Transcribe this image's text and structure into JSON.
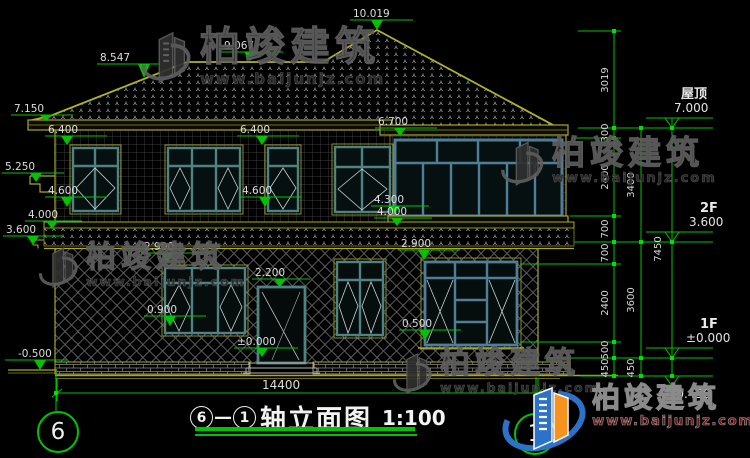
{
  "colors": {
    "green": "#00c400",
    "olive": "#a8a82c",
    "teal": "#4f8282",
    "bay": "#4d7f96",
    "white": "#dcdcdc"
  },
  "watermark": {
    "brand": "柏竣建筑",
    "url": "www.baijunjz.com"
  },
  "logo": {
    "brand": "柏竣建筑",
    "url": "www.baijunjz.com"
  },
  "axis_bubbles": {
    "left": "6",
    "right": "1"
  },
  "title": {
    "start": "6",
    "separator": "—",
    "end": "1",
    "text": "轴立面图",
    "scale": "1:100"
  },
  "bottom_dim": {
    "text": "14400"
  },
  "markers": [
    {
      "t": "10.019",
      "tx": 353,
      "ty": 8,
      "sx1": 350,
      "sx2": 413,
      "sy": 20,
      "cx": 377,
      "ay": 30
    },
    {
      "t": "9.067",
      "tx": 224,
      "ty": 40,
      "sx1": 221,
      "sx2": 283,
      "sy": 52,
      "cx": 250,
      "ay": 61
    },
    {
      "t": "8.547",
      "tx": 100,
      "ty": 52,
      "sx1": 97,
      "sx2": 159,
      "sy": 64,
      "cx": 144,
      "ay": 78
    },
    {
      "t": "7.150",
      "tx": 14,
      "ty": 103,
      "sx1": 11,
      "sx2": 73,
      "sy": 115,
      "cx": 46,
      "ay": 121
    },
    {
      "t": "6.400",
      "tx": 48,
      "ty": 124,
      "sx1": 45,
      "sx2": 107,
      "sy": 136,
      "cx": 67,
      "ay": 145
    },
    {
      "t": "6.400",
      "tx": 240,
      "ty": 124,
      "sx1": 237,
      "sx2": 299,
      "sy": 136,
      "cx": 262,
      "ay": 145
    },
    {
      "t": "6.700",
      "tx": 378,
      "ty": 116,
      "sx1": 375,
      "sx2": 437,
      "sy": 128,
      "cx": 400,
      "ay": 136
    },
    {
      "t": "5.250",
      "tx": 5,
      "ty": 161,
      "sx1": 2,
      "sx2": 64,
      "sy": 173,
      "cx": 36,
      "ay": 182
    },
    {
      "t": "4.600",
      "tx": 48,
      "ty": 185,
      "sx1": 45,
      "sx2": 107,
      "sy": 197,
      "cx": 67,
      "ay": 207
    },
    {
      "t": "4.600",
      "tx": 242,
      "ty": 185,
      "sx1": 239,
      "sx2": 301,
      "sy": 197,
      "cx": 265,
      "ay": 207
    },
    {
      "t": "4.300",
      "tx": 374,
      "ty": 194,
      "sx1": 371,
      "sx2": 429,
      "sy": 206,
      "cx": 394,
      "ay": 214
    },
    {
      "t": "4.000",
      "tx": 377,
      "ty": 206,
      "sx1": 374,
      "sx2": 432,
      "sy": 218,
      "cx": 397,
      "ay": 226
    },
    {
      "t": "4.000",
      "tx": 28,
      "ty": 209,
      "sx1": 25,
      "sx2": 82,
      "sy": 221,
      "cx": 52,
      "ay": 229
    },
    {
      "t": "3.600",
      "tx": 6,
      "ty": 224,
      "sx1": 3,
      "sx2": 62,
      "sy": 236,
      "cx": 33,
      "ay": 245
    },
    {
      "t": "2.900",
      "tx": 144,
      "ty": 241,
      "sx1": 141,
      "sx2": 203,
      "sy": 253,
      "cx": 167,
      "ay": 263
    },
    {
      "t": "0.900",
      "tx": 147,
      "ty": 304,
      "sx1": 144,
      "sx2": 206,
      "sy": 316,
      "cx": 170,
      "ay": 326
    },
    {
      "t": "2.200",
      "tx": 255,
      "ty": 267,
      "sx1": 252,
      "sx2": 310,
      "sy": 279,
      "cx": 280,
      "ay": 287
    },
    {
      "t": "±0.000",
      "tx": 237,
      "ty": 336,
      "sx1": 234,
      "sx2": 298,
      "sy": 348,
      "cx": 262,
      "ay": 357
    },
    {
      "t": "2.900",
      "tx": 401,
      "ty": 238,
      "sx1": 398,
      "sx2": 460,
      "sy": 250,
      "cx": 424,
      "ay": 260
    },
    {
      "t": "0.500",
      "tx": 402,
      "ty": 318,
      "sx1": 399,
      "sx2": 461,
      "sy": 330,
      "cx": 425,
      "ay": 340
    },
    {
      "t": "-0.500",
      "tx": 18,
      "ty": 348,
      "sx1": 5,
      "sx2": 67,
      "sy": 360,
      "cx": 40,
      "ay": 370
    }
  ],
  "vdims": [
    {
      "t": "3019",
      "x": 608,
      "y": 80
    },
    {
      "t": "300",
      "x": 608,
      "y": 133
    },
    {
      "t": "2400",
      "x": 608,
      "y": 177
    },
    {
      "t": "700",
      "x": 608,
      "y": 229
    },
    {
      "t": "700",
      "x": 608,
      "y": 253
    },
    {
      "t": "2400",
      "x": 608,
      "y": 303
    },
    {
      "t": "500",
      "x": 608,
      "y": 350
    },
    {
      "t": "450",
      "x": 608,
      "y": 368
    },
    {
      "t": "3400",
      "x": 634,
      "y": 185
    },
    {
      "t": "3600",
      "x": 634,
      "y": 300
    },
    {
      "t": "450",
      "x": 634,
      "y": 368
    },
    {
      "t": "7450",
      "x": 661,
      "y": 249
    }
  ],
  "right_levels": [
    {
      "label": "屋顶",
      "value": "7.000",
      "lx": 681,
      "lty": 86,
      "vx": 674,
      "vty": 101,
      "line_y": 118,
      "apex_y": 128
    },
    {
      "label": "2F",
      "value": "3.600",
      "lx": 700,
      "lty": 200,
      "vx": 689,
      "vty": 215,
      "line_y": 232,
      "apex_y": 242
    },
    {
      "label": "1F",
      "value": "±0.000",
      "lx": 700,
      "lty": 316,
      "vx": 686,
      "vty": 331,
      "line_y": 348,
      "apex_y": 358
    },
    {
      "label": "",
      "value": "-0.450",
      "lx": 0,
      "lty": 0,
      "vx": 672,
      "vty": 387,
      "line_y": 376,
      "apex_y": 386
    }
  ]
}
